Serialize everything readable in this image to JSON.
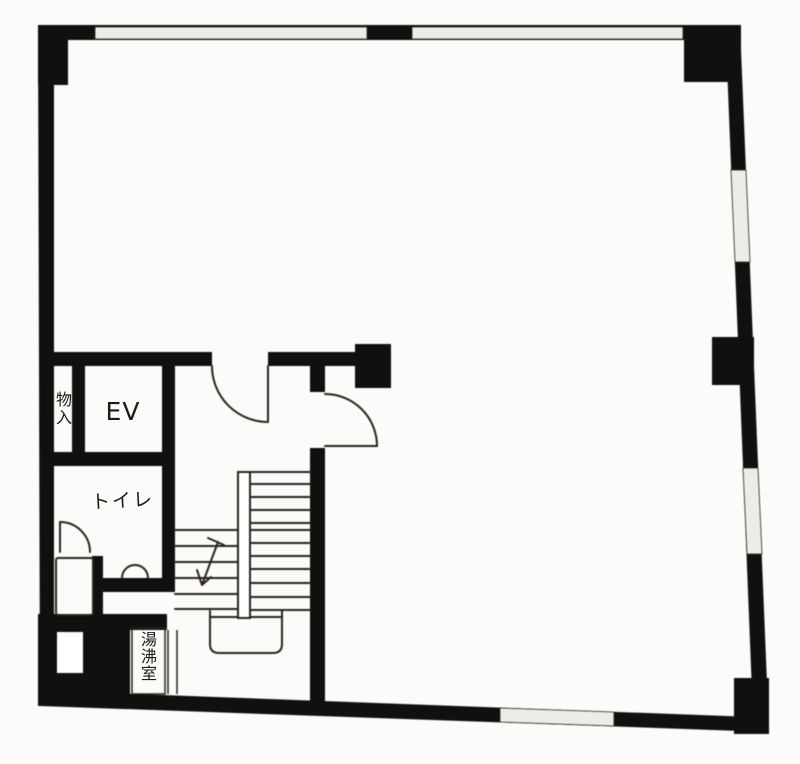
{
  "plan": {
    "labels": {
      "elevator": "EV",
      "storage": "物入",
      "toilet": "トイレ",
      "kitchenette": "湯沸室"
    },
    "colors": {
      "wall": "#171513",
      "line": "#2b2824",
      "paper": "#fcfbf9",
      "window": "#e9e7e1"
    }
  }
}
